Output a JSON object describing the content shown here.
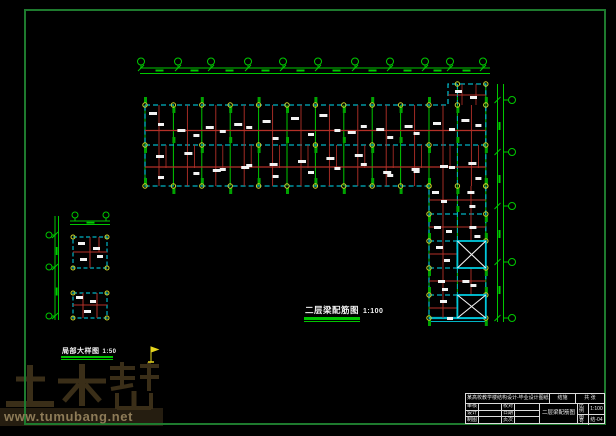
{
  "sheet": {
    "type": "cad-structural-drawing",
    "background": "#000000"
  },
  "colors": {
    "frame": "#1e7a2e",
    "grid": "#00c800",
    "dim": "#00c800",
    "cyan": "#00b4c4",
    "red": "#b43028",
    "yellow": "#ccd62c",
    "white": "#f2f2f2",
    "column": "#00a400",
    "xbox_border": "#00c8dc",
    "flag": "#e6d61e"
  },
  "titles": {
    "main": {
      "text": "二层梁配筋图",
      "scale": "1:100"
    },
    "detail": {
      "text": "局部大样图",
      "scale": "1:50"
    }
  },
  "watermark": {
    "logo_text": "土木帮",
    "url": "www.tumubang.net",
    "logo_color": "#3a2e18",
    "band_color": "#251d10",
    "url_color": "#8d7b57"
  },
  "title_block": {
    "project": "某高校教学楼结构设计-毕业设计图纸",
    "discipline": "结施",
    "sheet": "共 张",
    "left_rows": [
      [
        "审核",
        "",
        "校对",
        ""
      ],
      [
        "设计",
        "",
        "日期",
        ""
      ],
      [
        "制图",
        "",
        "页次",
        ""
      ]
    ],
    "drawing_name": "二层梁配筋图",
    "scale_label": "比例",
    "scale_value": "1:100",
    "no_label": "图号",
    "no_value": "结-04"
  },
  "plan": {
    "frame": [
      25,
      10,
      580,
      414
    ],
    "col_start": 145,
    "col_spacing": 28.4,
    "col_count": 13,
    "hw_rows": [
      105,
      145,
      186
    ],
    "vw_x": [
      429,
      457.4,
      485.8
    ],
    "vw_rows": [
      186,
      214,
      241,
      268,
      295,
      318
    ],
    "outline": "M145,105 L448,105 L448,84 L485.8,84 L485.8,318 L429,318 L429,186 L145,186 Z",
    "xboxes": [
      [
        457.4,
        241,
        485.8,
        268
      ],
      [
        457.4,
        295,
        485.8,
        318
      ]
    ],
    "red_h_hw": [
      130.5,
      167
    ],
    "red_h_vw": [
      200,
      227,
      254,
      281,
      308
    ],
    "top_dim": {
      "y1": 68,
      "y2": 73.5,
      "x1": 140,
      "x2": 490,
      "bubbles": [
        141,
        178,
        211,
        248,
        283,
        318,
        355,
        390,
        425,
        450,
        483
      ],
      "bubble_y": 61.5
    },
    "right_dim": {
      "x1": 497.5,
      "x2": 503.5,
      "y1": 84,
      "y2": 322,
      "bubbles": [
        100,
        152,
        206,
        262,
        318
      ],
      "bubble_x": 512
    },
    "left_dim_v": {
      "x1": 55,
      "x2": 58.5,
      "y1": 216,
      "y2": 320,
      "bubbles": [
        235,
        267,
        316
      ],
      "bubble_x": 49
    },
    "left_dim_h": {
      "y1": 221,
      "y2": 224.5,
      "x1": 70,
      "x2": 110,
      "bubbles": [
        75,
        106
      ],
      "bubble_y": 215
    },
    "detail1": [
      73,
      237,
      34,
      31
    ],
    "detail2": [
      73,
      293,
      34,
      25
    ]
  }
}
